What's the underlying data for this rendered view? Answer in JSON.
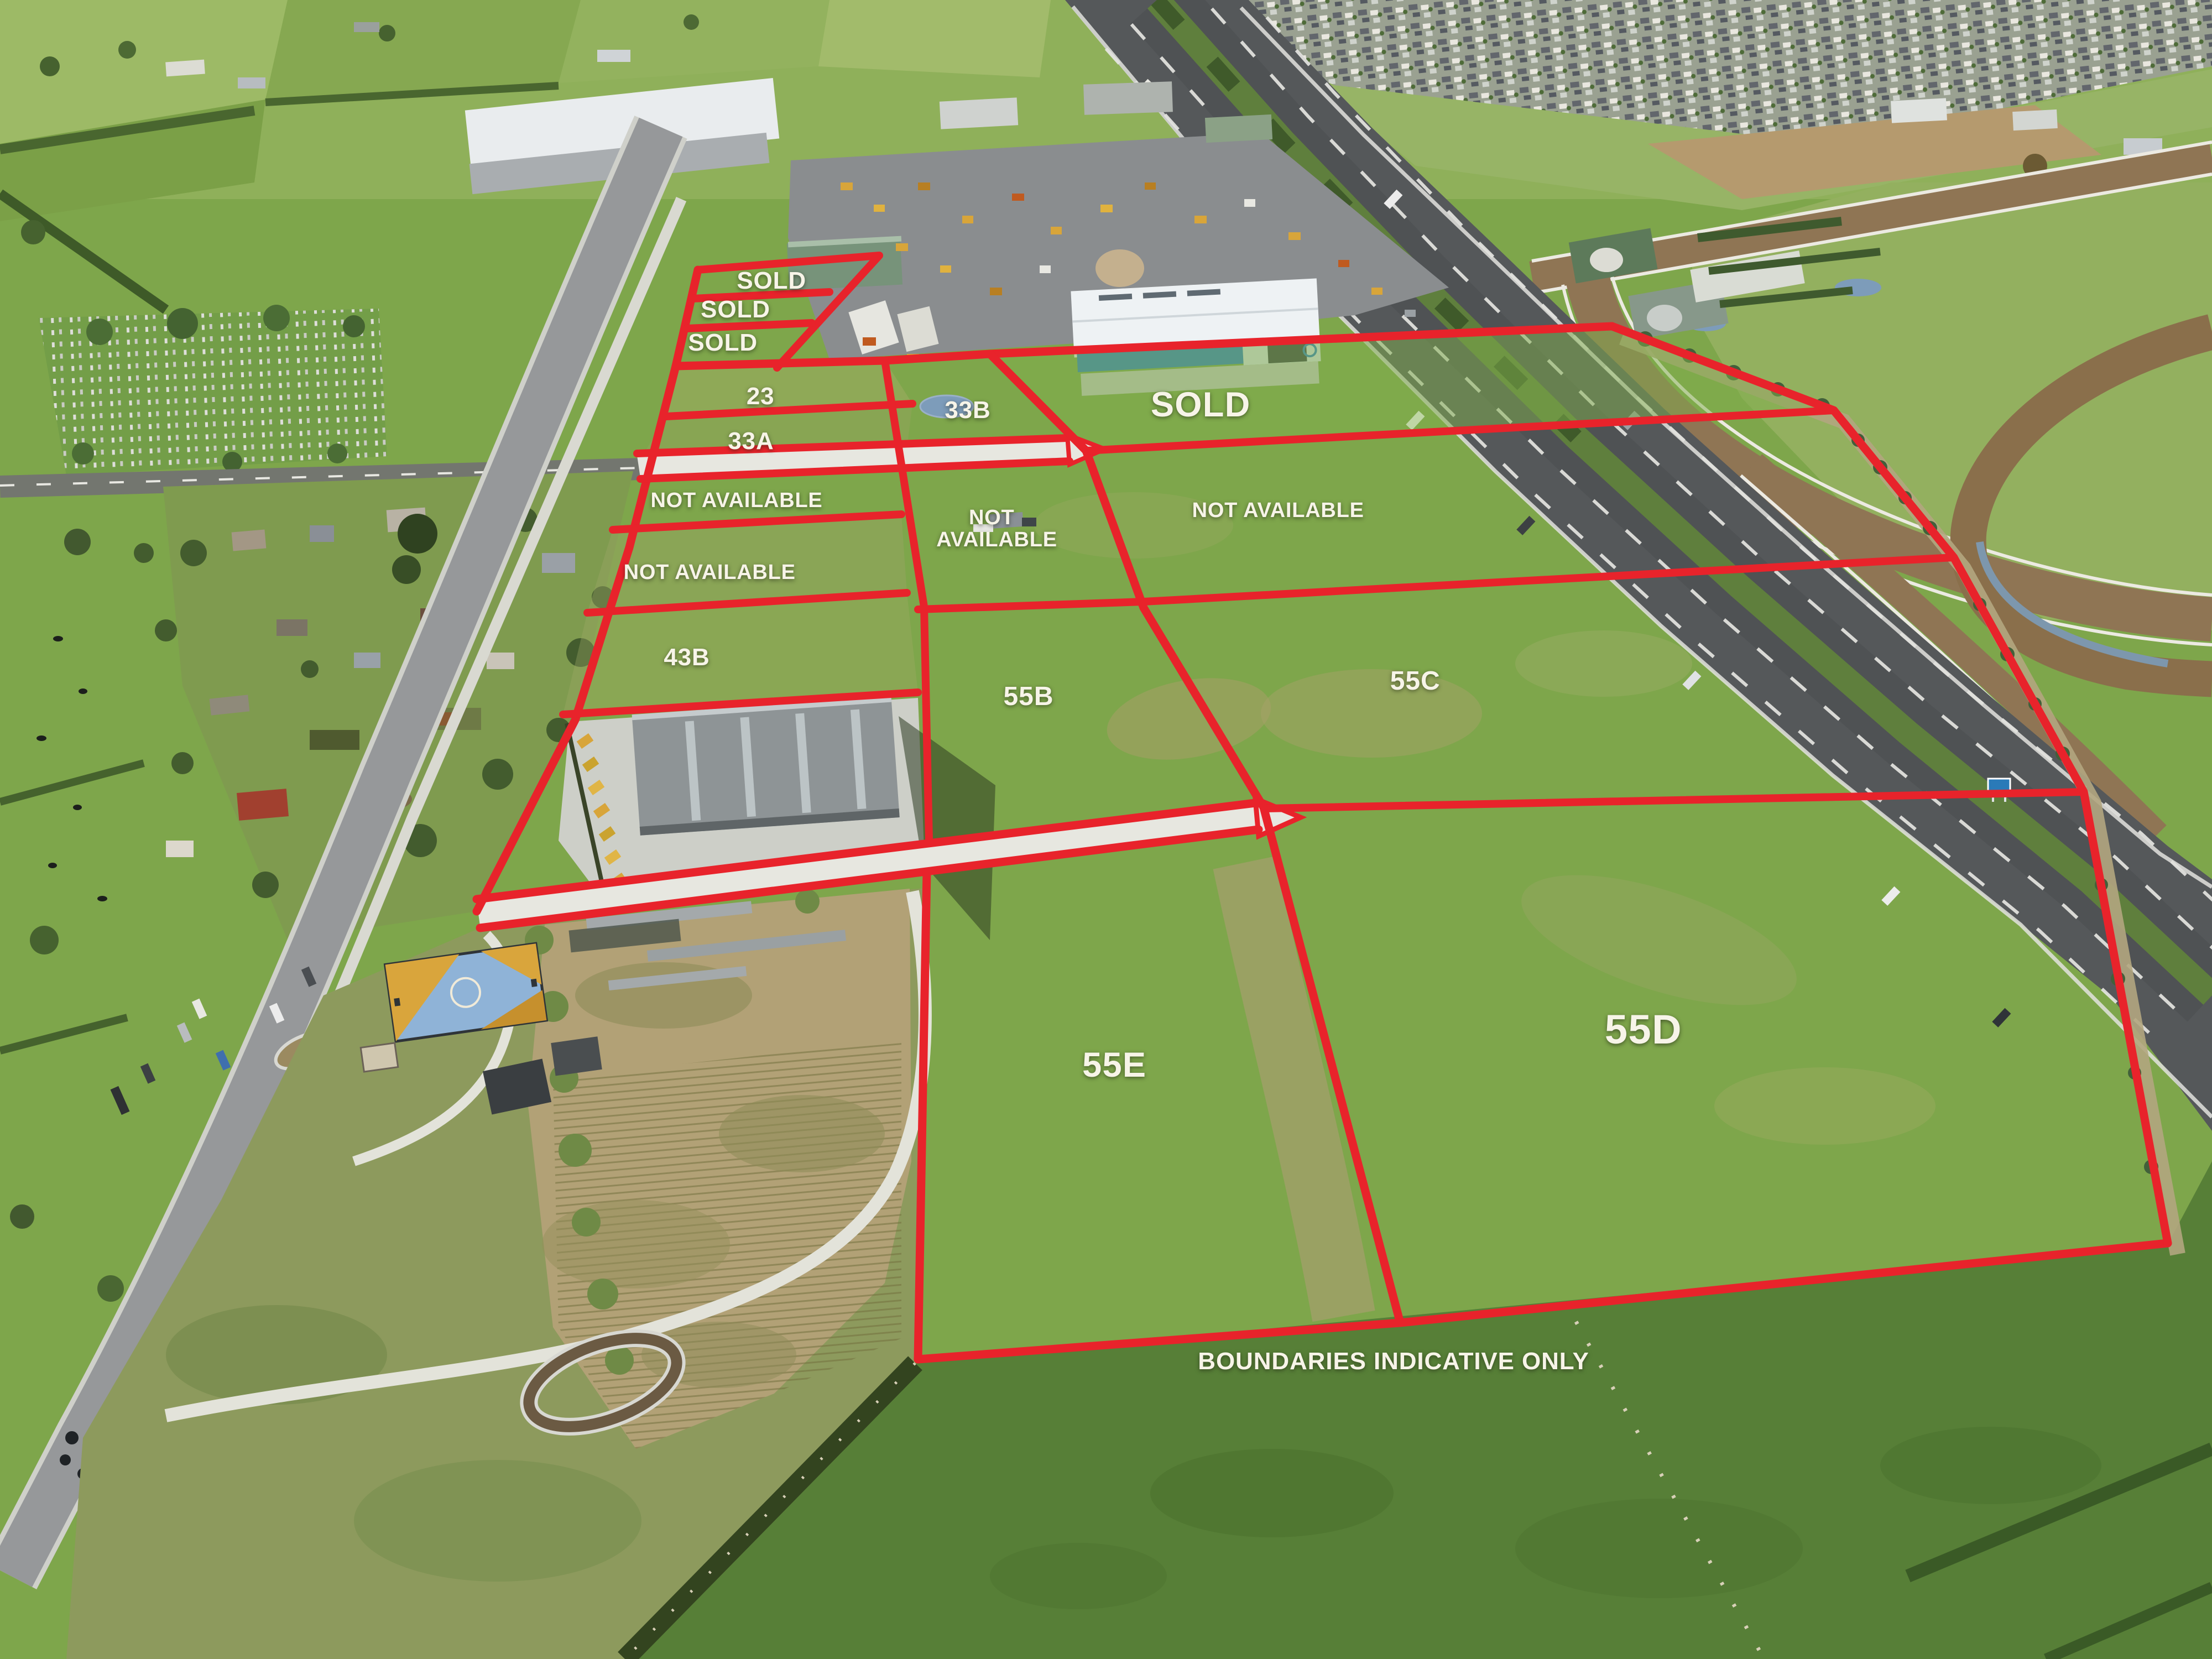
{
  "view": "aerial-subdivision-site-plan",
  "disclaimer": "BOUNDARIES INDICATIVE ONLY",
  "colors": {
    "boundary": "#e8232b",
    "label_text": "#f7f4e8",
    "grass": "#7ea64b",
    "pasture_dark": "#577f37",
    "highway_asphalt": "#55585a",
    "racetrack_dirt": "#8f7554",
    "warehouse_blue": "#2f7fc2",
    "concrete": "#d8d8d2"
  },
  "labels": [
    {
      "id": "sold-a",
      "text": "SOLD",
      "x": 34.88,
      "y": 16.93,
      "size": "sm"
    },
    {
      "id": "sold-b",
      "text": "SOLD",
      "x": 33.25,
      "y": 18.67,
      "size": "sm"
    },
    {
      "id": "sold-c",
      "text": "SOLD",
      "x": 32.68,
      "y": 20.67,
      "size": "sm"
    },
    {
      "id": "lot-23",
      "text": "23",
      "x": 34.38,
      "y": 23.9,
      "size": "sm"
    },
    {
      "id": "lot-33a",
      "text": "33A",
      "x": 33.95,
      "y": 26.6,
      "size": "sm"
    },
    {
      "id": "lot-33b",
      "text": "33B",
      "x": 43.75,
      "y": 24.73,
      "size": "sm"
    },
    {
      "id": "sold-main",
      "text": "SOLD",
      "x": 54.28,
      "y": 24.4,
      "size": "lg"
    },
    {
      "id": "not-available-1",
      "text": "NOT AVAILABLE",
      "x": 33.3,
      "y": 30.2,
      "size": "xs"
    },
    {
      "id": "not-available-2",
      "text": "NOT AVAILABLE",
      "x": 32.08,
      "y": 34.53,
      "size": "xs"
    },
    {
      "id": "not-available-centre",
      "text": "NOT AVAILABLE",
      "x": 44.83,
      "y": 31.9,
      "size": "xs",
      "wrap": true
    },
    {
      "id": "not-available-right",
      "text": "NOT AVAILABLE",
      "x": 57.78,
      "y": 30.8,
      "size": "xs"
    },
    {
      "id": "lot-43b",
      "text": "43B",
      "x": 31.05,
      "y": 39.63,
      "size": "sm"
    },
    {
      "id": "lot-55b",
      "text": "55B",
      "x": 46.5,
      "y": 42.0,
      "size": "md"
    },
    {
      "id": "lot-55c",
      "text": "55C",
      "x": 63.98,
      "y": 41.07,
      "size": "md"
    },
    {
      "id": "lot-55e",
      "text": "55E",
      "x": 50.38,
      "y": 64.2,
      "size": "lg"
    },
    {
      "id": "lot-55d",
      "text": "55D",
      "x": 74.3,
      "y": 62.07,
      "size": "xl"
    }
  ]
}
